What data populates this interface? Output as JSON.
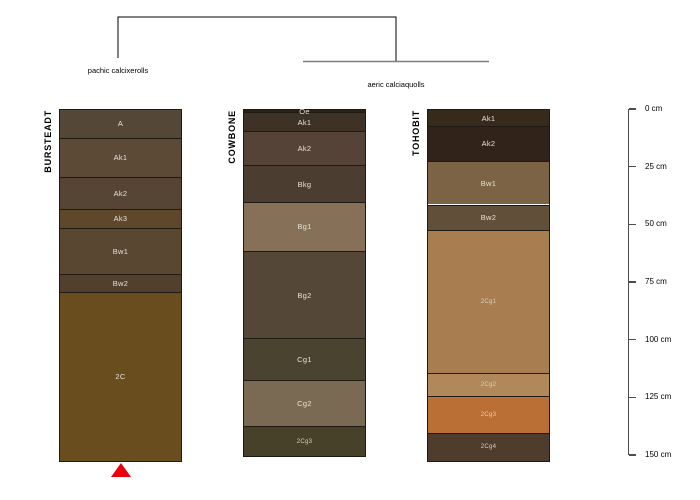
{
  "chart_data": {
    "type": "other",
    "subtype": "soil-profile-depth-plot-with-dendrogram",
    "depth_axis": {
      "unit": "cm",
      "min": 0,
      "max": 150,
      "tick_interval": 25,
      "tick_values": [
        0,
        25,
        50,
        75,
        100,
        125,
        150
      ],
      "tick_labels": [
        "0 cm",
        "25 cm",
        "50 cm",
        "75 cm",
        "100 cm",
        "125 cm",
        "150 cm"
      ]
    },
    "dendrogram": {
      "groups": [
        {
          "label": "pachic calcixerolls",
          "members": [
            "BURSTEADT"
          ]
        },
        {
          "label": "aeric calciaquolls",
          "members": [
            "COWBONE",
            "TOHOBIT"
          ]
        }
      ]
    },
    "profiles": [
      {
        "name": "BURSTEADT",
        "group": "pachic calcixerolls",
        "marker": {
          "shape": "triangle-up",
          "color": "#e8000b"
        },
        "horizons": [
          {
            "name": "A",
            "top_cm": 0,
            "bottom_cm": 12,
            "color": "#554738"
          },
          {
            "name": "Ak1",
            "top_cm": 12,
            "bottom_cm": 29,
            "color": "#5c4a37"
          },
          {
            "name": "Ak2",
            "top_cm": 29,
            "bottom_cm": 43,
            "color": "#564535"
          },
          {
            "name": "Ak3",
            "top_cm": 43,
            "bottom_cm": 51,
            "color": "#5e472a"
          },
          {
            "name": "Bw1",
            "top_cm": 51,
            "bottom_cm": 71,
            "color": "#594732"
          },
          {
            "name": "Bw2",
            "top_cm": 71,
            "bottom_cm": 79,
            "color": "#51402c"
          },
          {
            "name": "2C",
            "top_cm": 79,
            "bottom_cm": 152,
            "color": "#6a4d1e"
          }
        ]
      },
      {
        "name": "COWBONE",
        "group": "aeric calciaquolls",
        "horizons": [
          {
            "name": "Oe",
            "top_cm": 0,
            "bottom_cm": 1,
            "color": "#2c2115"
          },
          {
            "name": "Ak1",
            "top_cm": 1,
            "bottom_cm": 9,
            "color": "#3e3126"
          },
          {
            "name": "Ak2",
            "top_cm": 9,
            "bottom_cm": 24,
            "color": "#544336"
          },
          {
            "name": "Bkg",
            "top_cm": 24,
            "bottom_cm": 40,
            "color": "#4b3e31"
          },
          {
            "name": "Bg1",
            "top_cm": 40,
            "bottom_cm": 61,
            "color": "#867158"
          },
          {
            "name": "Bg2",
            "top_cm": 61,
            "bottom_cm": 99,
            "color": "#554738"
          },
          {
            "name": "Cg1",
            "top_cm": 99,
            "bottom_cm": 117,
            "color": "#4a432f"
          },
          {
            "name": "Cg2",
            "top_cm": 117,
            "bottom_cm": 137,
            "color": "#7b6a53"
          },
          {
            "name": "2Cg3",
            "top_cm": 137,
            "bottom_cm": 150,
            "color": "#48412a"
          }
        ]
      },
      {
        "name": "TOHOBIT",
        "group": "aeric calciaquolls",
        "horizons": [
          {
            "name": "Ak1",
            "top_cm": 0,
            "bottom_cm": 7,
            "color": "#372a1d"
          },
          {
            "name": "Ak2",
            "top_cm": 7,
            "bottom_cm": 22,
            "color": "#31231a"
          },
          {
            "name": "Bw1",
            "top_cm": 22,
            "bottom_cm": 41,
            "color": "#7c6345"
          },
          {
            "name": "Bw2",
            "top_cm": 41,
            "bottom_cm": 52,
            "color": "#624f39"
          },
          {
            "name": "2Cg1",
            "top_cm": 52,
            "bottom_cm": 114,
            "color": "#a87e50"
          },
          {
            "name": "2Cg2",
            "top_cm": 114,
            "bottom_cm": 124,
            "color": "#b0885a"
          },
          {
            "name": "2Cg3",
            "top_cm": 124,
            "bottom_cm": 140,
            "color": "#ba7034"
          },
          {
            "name": "2Cg4",
            "top_cm": 140,
            "bottom_cm": 152,
            "color": "#4e3d2c"
          }
        ]
      }
    ],
    "line_colors": {
      "cluster_top": "#000000",
      "cluster_sub": "#7f7f7f",
      "axis": "#4d4d4d"
    }
  }
}
